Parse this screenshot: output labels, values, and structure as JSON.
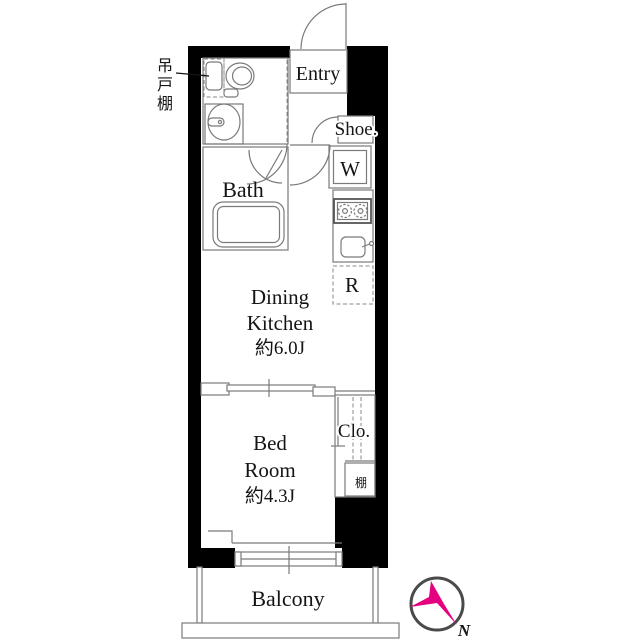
{
  "rooms": {
    "entry": {
      "label": "Entry"
    },
    "shoe": {
      "label": "Shoe."
    },
    "washer": {
      "label": "W"
    },
    "fridge": {
      "label": "R"
    },
    "bath": {
      "label": "Bath"
    },
    "dining_kitchen": {
      "line1": "Dining",
      "line2": "Kitchen",
      "area": "約6.0J"
    },
    "bedroom": {
      "line1": "Bed",
      "line2": "Room",
      "area": "約4.3J"
    },
    "closet": {
      "label": "Clo."
    },
    "shelf": {
      "label": "棚"
    },
    "balcony": {
      "label": "Balcony"
    },
    "hanging_cupboard": {
      "label": "吊戸棚",
      "chars": [
        "吊",
        "戸",
        "棚"
      ]
    }
  },
  "compass": {
    "north_label": "N"
  },
  "colors": {
    "wall": "#000000",
    "line": "#7a7a7a",
    "text": "#141414",
    "compass_needle": "#e4007f",
    "compass_ring": "#4a4a4a",
    "background": "#ffffff"
  }
}
